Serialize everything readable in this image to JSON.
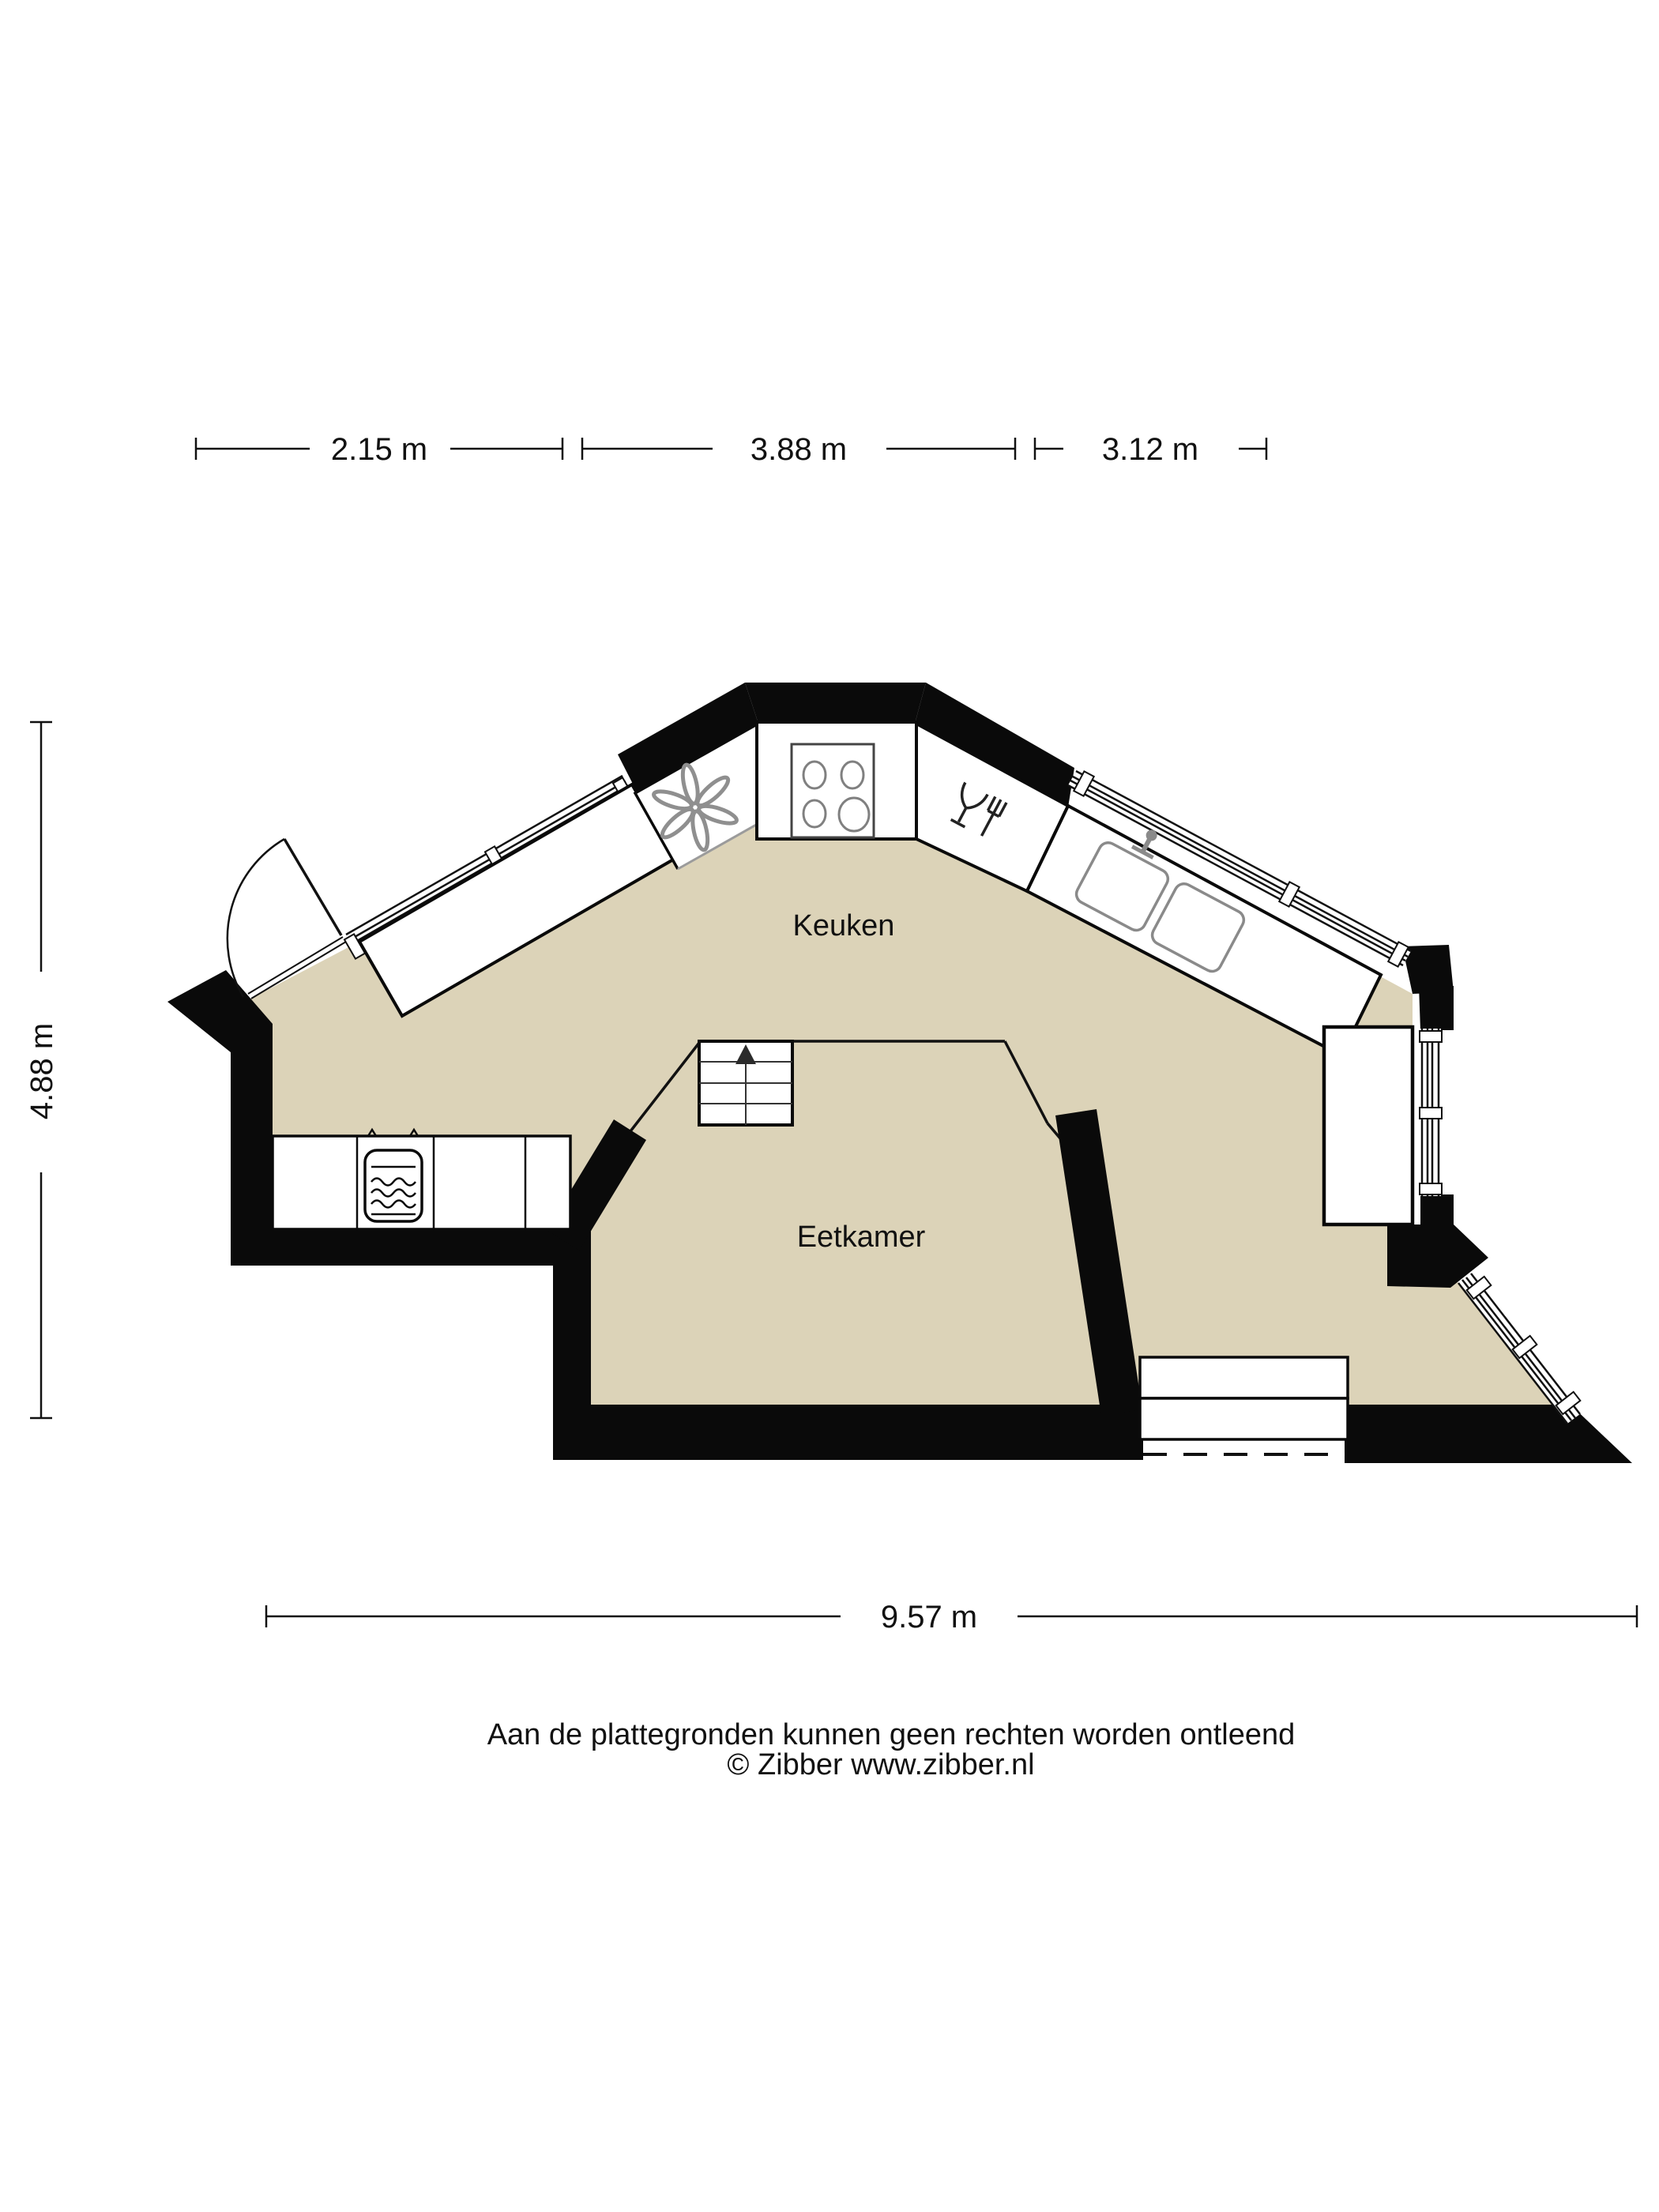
{
  "document": {
    "type": "floorplan",
    "colors": {
      "floor": "#dcd3b8",
      "wall": "#0a0a0a",
      "line": "#111111",
      "appliance_gray": "#8f8f8f",
      "background": "#ffffff"
    }
  },
  "rooms": {
    "kitchen": {
      "label": "Keuken"
    },
    "dining": {
      "label": "Eetkamer"
    }
  },
  "fixtures": {
    "extractor_fan": "extractor-fan",
    "stove": "stove-4-burners",
    "dishwasher": "dishwasher",
    "sink": "double-sink-with-faucet",
    "microwave": "microwave-oven",
    "stairs": "stairs-up-arrow",
    "door": "swing-door",
    "steps": "entry-steps",
    "tall_cabinet": "tall-cabinet"
  },
  "dimensions": {
    "top_segments": [
      {
        "label": "2.15 m"
      },
      {
        "label": "3.88 m"
      },
      {
        "label": "3.12 m"
      }
    ],
    "bottom": {
      "label": "9.57 m"
    },
    "left": {
      "label": "4.88 m"
    }
  },
  "footer": {
    "disclaimer": "Aan de plattegronden kunnen geen rechten worden ontleend",
    "copyright": "© Zibber www.zibber.nl"
  }
}
